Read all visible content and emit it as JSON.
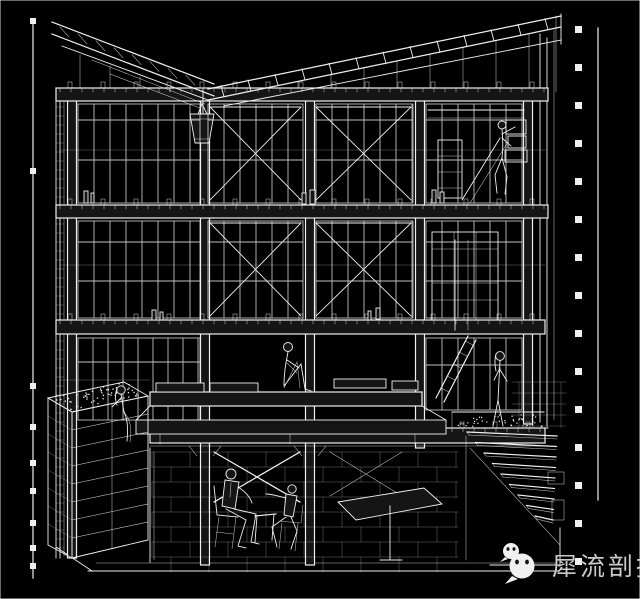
{
  "meta": {
    "type": "architectural-section-drawing",
    "subject": "three-story frame building cutaway section, white wireframe on black",
    "floors": 3,
    "stair_steps": 9
  },
  "colors": {
    "background": "#151515",
    "line": "#f0f0f0",
    "dim_line": "#cfcfcf",
    "watermark_text": "#d6d6d6",
    "icon_fill": "#ffffff",
    "icon_eyes": "#151515"
  },
  "watermark": {
    "icon": "wechat-icon",
    "text": "犀流剖报"
  },
  "figures": [
    "person-climbing-shelves-top-right",
    "person-sitting-on-center-bench",
    "person-sitting-on-planter-left",
    "person-standing-at-stair-landing",
    "person-seated-basement-left",
    "person-seated-basement-right"
  ]
}
